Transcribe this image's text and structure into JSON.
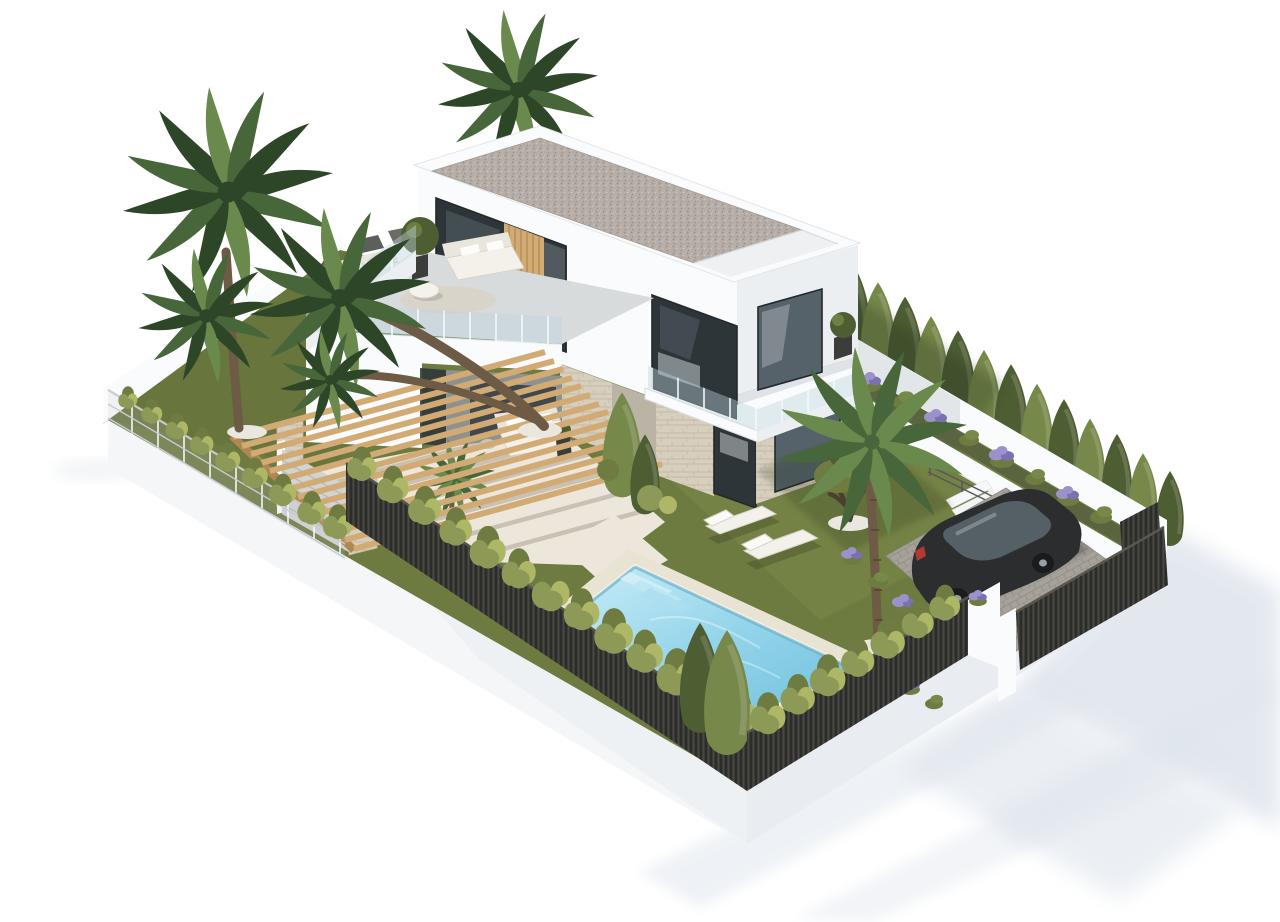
{
  "scene": {
    "title": "Modern two-storey villa with garden and pool — aerial 3D architectural render",
    "type": "architectural-3d-visualization",
    "view": "aerial three-quarter isometric view on plain white background",
    "objects": [
      {
        "name": "villa",
        "description": "white modern two-storey house with flat gravel roof and large glass windows"
      },
      {
        "name": "roof-terrace",
        "description": "first-floor terrace with white lounge sofas, armchairs, round table and glass balustrade"
      },
      {
        "name": "balcony",
        "description": "cantilevered corner balcony with glass railing and potted plant"
      },
      {
        "name": "pergola",
        "description": "timber beam pergola on stone pillars over the patio"
      },
      {
        "name": "patio",
        "description": "cream tiled terrace with outdoor sofa and side table"
      },
      {
        "name": "swimming-pool",
        "description": "rectangular turquoise pool with corner steps and stone deck"
      },
      {
        "name": "sun-loungers",
        "count": 2,
        "description": "white chaise lounges on the lawn beside the pool"
      },
      {
        "name": "lawn",
        "description": "green garden lawn surrounding the house"
      },
      {
        "name": "palm-trees",
        "count": 6,
        "description": "fan palms at the left, behind the roof, by the patio and near the driveway"
      },
      {
        "name": "olive-tree",
        "description": "gnarled olive tree on a white pebble circle"
      },
      {
        "name": "cypress-hedge",
        "description": "row of tall cypresses along the rear boundary wall"
      },
      {
        "name": "hedge-rows",
        "description": "low shrub hedges along the perimeter fences"
      },
      {
        "name": "dark-slatted-fence",
        "description": "dark vertical-slat fence on the street boundaries"
      },
      {
        "name": "wire-fence",
        "description": "light wire fence on the upper-left boundary"
      },
      {
        "name": "entrance-gate",
        "description": "dark slatted sliding gate beside a white pillar"
      },
      {
        "name": "driveway",
        "description": "grey paved parking area"
      },
      {
        "name": "car",
        "description": "dark saloon car parked on the driveway"
      },
      {
        "name": "garden-stairs",
        "description": "white steps with metal railing between garden and driveway"
      },
      {
        "name": "flower-beds",
        "description": "planting beds with purple lavender and green shrubs"
      },
      {
        "name": "retaining-walls",
        "description": "white perimeter and planter walls"
      },
      {
        "name": "ground-shadows",
        "description": "soft blue-grey shadows cast on the white ground"
      }
    ]
  },
  "colors": {
    "bg": "#ffffff",
    "shadow": "#dfe5ed",
    "wallLit": "#fafbfc",
    "wallShade": "#eceff2",
    "wallDark": "#dfe3e8",
    "terraceFloor": "#d8dbdc",
    "roofGravel": "#b5ada6",
    "gravelDot1": "#978f88",
    "gravelDot2": "#ccc6c0",
    "glassDark": "#2e3538",
    "glassMid": "#55626a",
    "glassLight": "#8fa0a8",
    "glassRail": "#bdd4de",
    "stone": "#d7cfbe",
    "stoneLine": "#bfb49d",
    "wood": "#d2ab74",
    "woodDark": "#af8752",
    "grass": "#6d7b41",
    "grassLight": "#7c8b4b",
    "grassDark": "#5c6a36",
    "hedge": "#8d9a57",
    "hedgeLight": "#adb766",
    "hedgeDark": "#6e7c41",
    "cypress": "#4e5e33",
    "cypressLight": "#77894a",
    "palmDark": "#2e4628",
    "palmMid": "#47663a",
    "palmLight": "#6a894d",
    "trunk": "#6d5b45",
    "trunkDark": "#4c3f30",
    "pebble": "#e9e7e0",
    "soil": "#5a6540",
    "deck": "#e9e3d3",
    "coping": "#f3efe4",
    "waterLight": "#c8ecf7",
    "water": "#93d4ea",
    "waterDeep": "#6fbfdc",
    "poolEdge": "#59a8c6",
    "fence": "#3b3a36",
    "wire": "#c8ccd1",
    "gateGray": "#d2d4d4",
    "drive": "#a6a29a",
    "paver": "#8e8a82",
    "carBody": "#2b2d2f",
    "carGlass": "#555f66",
    "wheel": "#1a1b1d",
    "rim": "#989ea4",
    "tail": "#b23a2e",
    "flower": "#9c92cb",
    "flowerDeep": "#7b70b2",
    "furnWhite": "#f3f1ea",
    "furnFrame": "#d7d3c7",
    "furnBack": "#e9e6de",
    "darkPot": "#3b3d3b",
    "pathc": "#ece7da"
  }
}
